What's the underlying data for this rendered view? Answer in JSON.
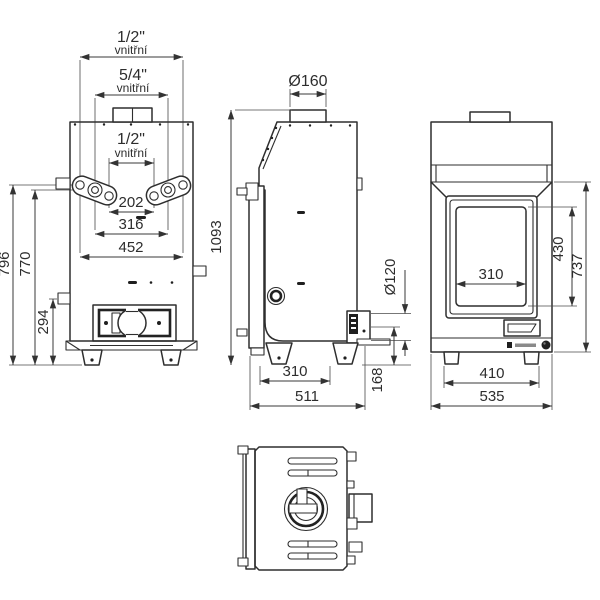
{
  "drawing": {
    "type": "technical-orthographic-views-stove-boiler",
    "line_color": "#2e2e2e",
    "background": "#ffffff",
    "dims": {
      "rear_top_outer_size": "1/2\"",
      "rear_top_outer_note": "vnitřní",
      "rear_top_mid_size": "5/4\"",
      "rear_top_mid_note": "vnitřní",
      "rear_inner_size": "1/2\"",
      "rear_inner_note": "vnitřní",
      "rear_spacing_inner": "202",
      "rear_spacing_mid": "316",
      "rear_spacing_outer": "452",
      "rear_height_total": "796",
      "rear_height_connections": "770",
      "rear_height_drain": "294",
      "side_height_total": "1093",
      "side_flue_diameter": "Ø160",
      "side_port_diameter": "Ø120",
      "side_leg_spacing": "310",
      "side_depth_total": "511",
      "side_port_height": "168",
      "front_glass_width": "310",
      "front_glass_height": "430",
      "front_door_height": "737",
      "front_leg_spacing": "410",
      "front_width_total": "535"
    }
  }
}
